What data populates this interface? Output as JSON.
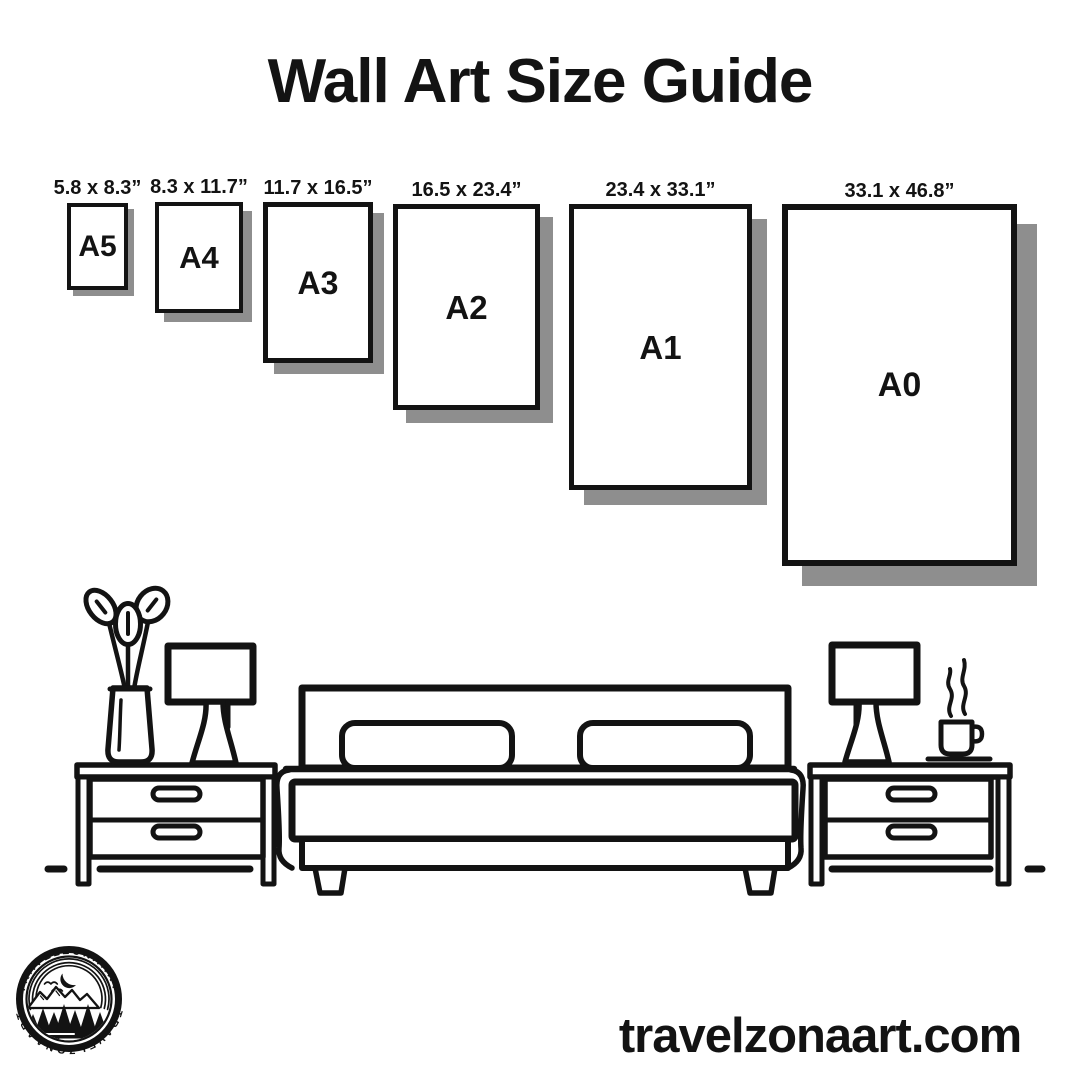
{
  "page": {
    "title": "Wall Art Size Guide",
    "website_url": "travelzonaart.com"
  },
  "colors": {
    "ink": "#131313",
    "paper_shadow": "#8e8e8e",
    "background": "#ffffff"
  },
  "size_guide": {
    "frames": [
      {
        "code": "A5",
        "dimensions": "5.8 x 8.3”",
        "left": 67,
        "top": 203,
        "width": 61,
        "height": 87,
        "border": 4,
        "shadow_offset": 6,
        "code_size": 30
      },
      {
        "code": "A4",
        "dimensions": "8.3 x 11.7”",
        "left": 155,
        "top": 202,
        "width": 88,
        "height": 111,
        "border": 4,
        "shadow_offset": 9,
        "code_size": 31
      },
      {
        "code": "A3",
        "dimensions": "11.7 x 16.5”",
        "left": 263,
        "top": 202,
        "width": 110,
        "height": 161,
        "border": 5,
        "shadow_offset": 11,
        "code_size": 32
      },
      {
        "code": "A2",
        "dimensions": "16.5 x 23.4”",
        "left": 393,
        "top": 204,
        "width": 147,
        "height": 206,
        "border": 5,
        "shadow_offset": 13,
        "code_size": 33
      },
      {
        "code": "A1",
        "dimensions": "23.4 x 33.1”",
        "left": 569,
        "top": 204,
        "width": 183,
        "height": 286,
        "border": 5,
        "shadow_offset": 15,
        "code_size": 33
      },
      {
        "code": "A0",
        "dimensions": "33.1 x 46.8”",
        "left": 782,
        "top": 204,
        "width": 235,
        "height": 362,
        "border": 6,
        "shadow_offset": 20,
        "code_size": 34
      }
    ]
  },
  "logo": {
    "arc_text_top": "TRAVELZONAART",
    "arc_text_bottom": "TRAVELZONAART"
  }
}
